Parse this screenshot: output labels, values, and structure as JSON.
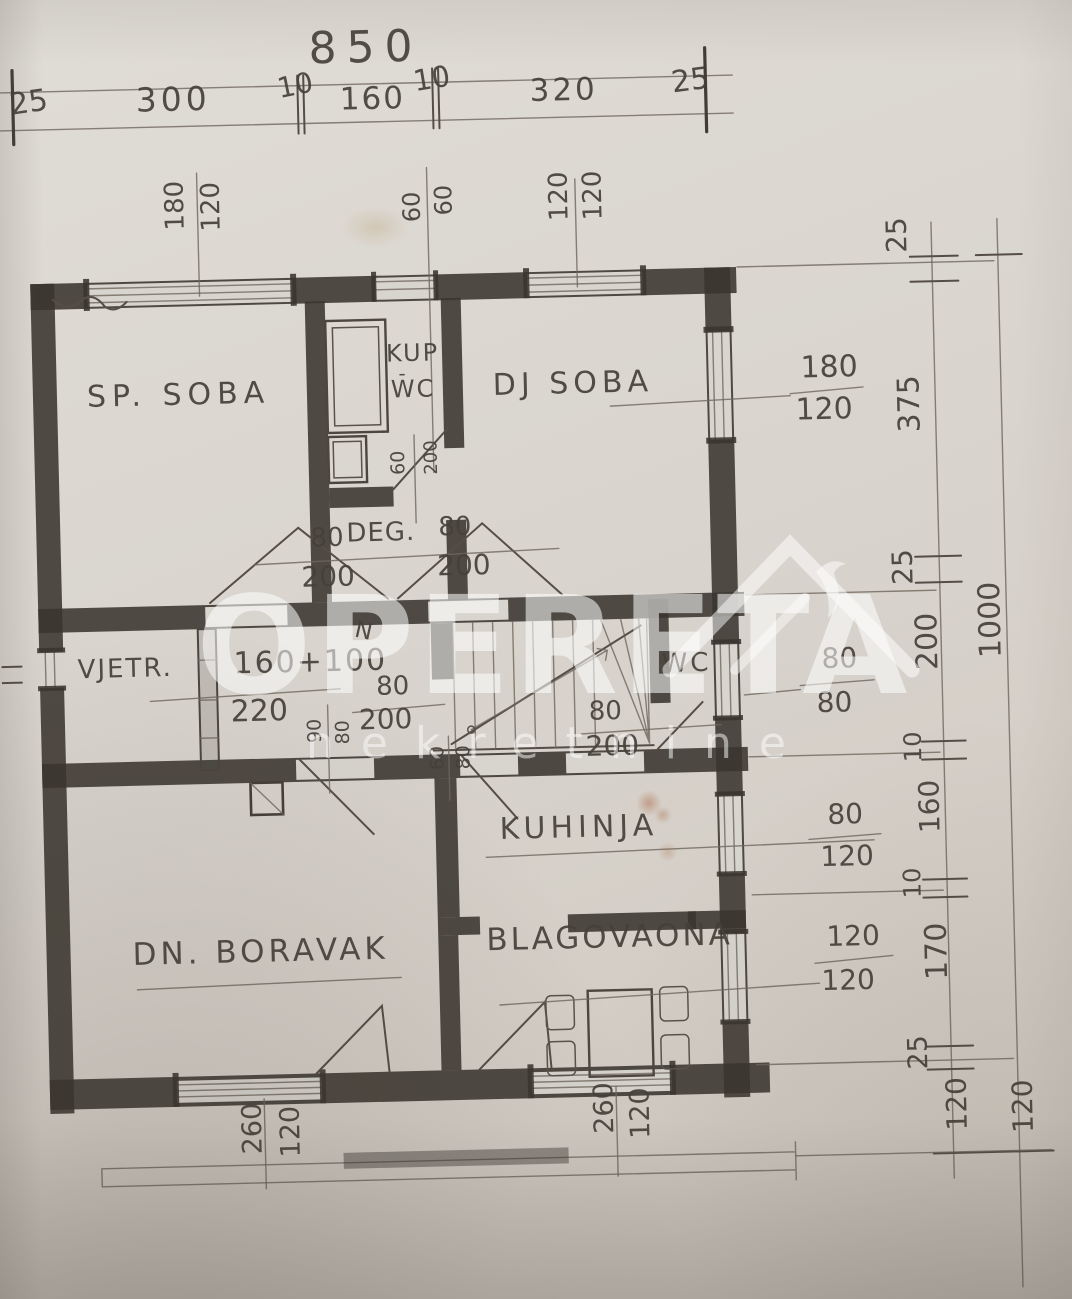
{
  "watermark": {
    "brand": "OPERETA",
    "subtitle": "nekretnine"
  },
  "rooms": {
    "sp_soba": "SP. SOBA",
    "kup_line1": "KUP",
    "kup_sep": "-",
    "kup_line2": "WC",
    "dj_soba": "DJ SOBA",
    "vjetr": "VJETR.",
    "deg": "DEG.",
    "wc": "WC",
    "kuhinja": "KUHINJA",
    "dn_boravak": "DN. BORAVAK",
    "blagovaona": "BLAGOVAONA"
  },
  "dims": {
    "top_total": "850",
    "top_segments": [
      "25",
      "300",
      "10",
      "160",
      "10",
      "320",
      "25"
    ],
    "right_total": "1000",
    "right_segments": [
      "25",
      "375",
      "25",
      "200",
      "10",
      "160",
      "10",
      "170",
      "25"
    ],
    "right_below_inner": "120",
    "right_below_outer": "120",
    "tag_sp_window": {
      "a": "180",
      "b": "120"
    },
    "tag_bath_window": {
      "a": "60",
      "b": "60"
    },
    "tag_dj_window": {
      "a": "120",
      "b": "120"
    },
    "frac_dj_window": {
      "num": "180",
      "den": "120"
    },
    "frac_wc_window": {
      "num": "80",
      "den": "80"
    },
    "frac_kitchen_window": {
      "num": "80",
      "den": "120"
    },
    "frac_dining_window": {
      "num": "120",
      "den": "120"
    },
    "frac_entry": {
      "num": "160+100",
      "den": "220"
    },
    "frac_hall_door": {
      "num": "80",
      "den": "200"
    },
    "frac_stair_door": {
      "num": "80",
      "den": "200"
    },
    "frac_deg_left": {
      "num": "80",
      "den": "200"
    },
    "frac_deg_right": {
      "num": "80",
      "den": "200"
    },
    "tag_bath_door": {
      "a": "60",
      "b": "200"
    },
    "tag_boravak_door": {
      "a": "90",
      "b": "80"
    },
    "tag_kitchen_door": {
      "a": "60",
      "b": "80"
    },
    "tag_bottom_left_window": {
      "a": "260",
      "b": "120"
    },
    "tag_bottom_right_window": {
      "a": "260",
      "b": "120"
    },
    "stair_mark": "N"
  }
}
